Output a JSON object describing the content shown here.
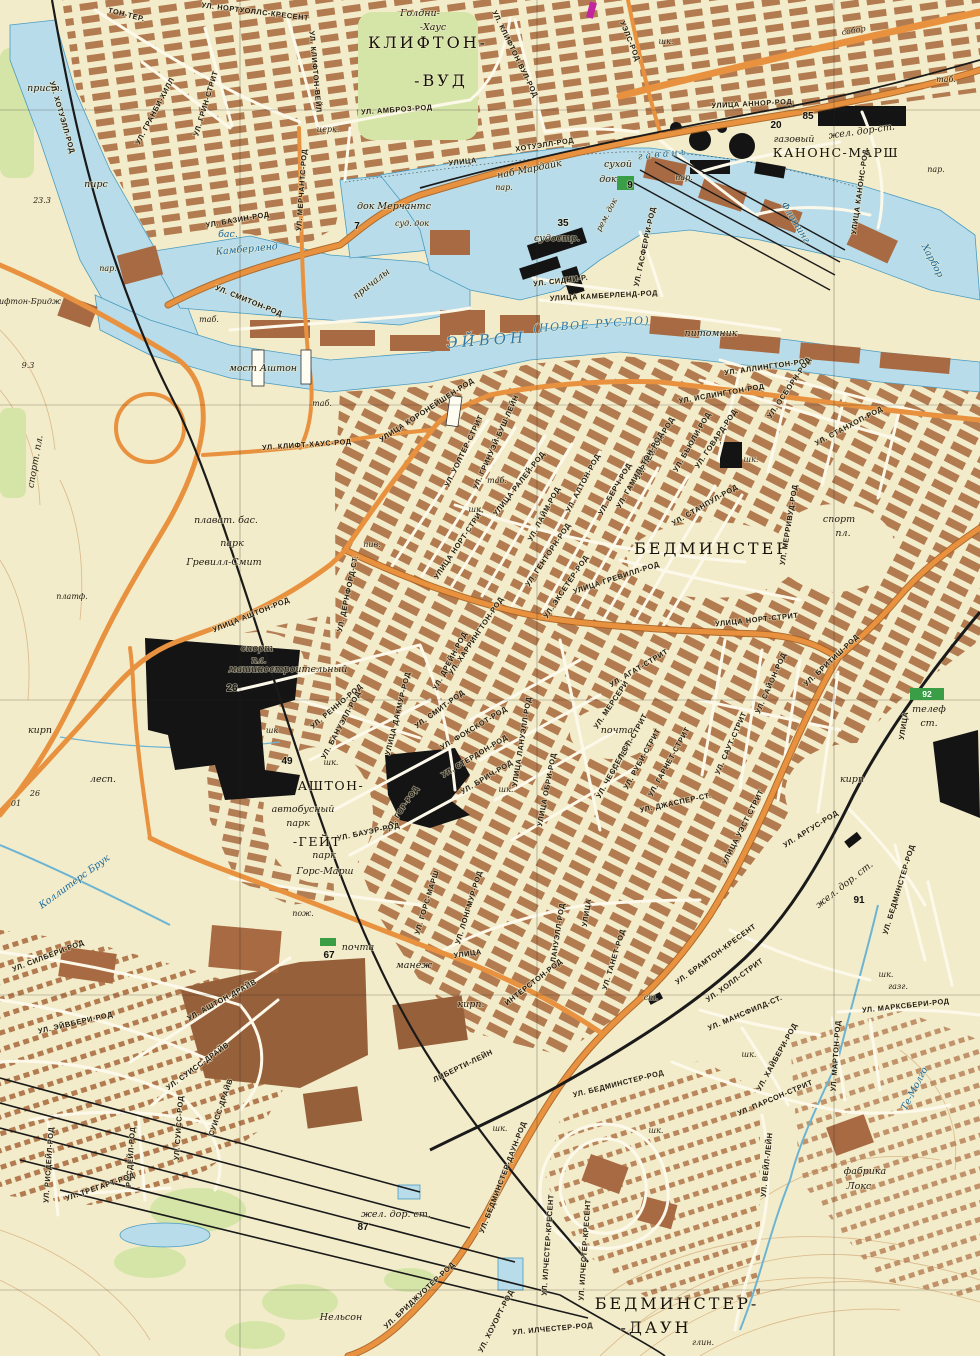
{
  "map": {
    "type": "soviet-topographic-city-map",
    "colors": {
      "paper": "#f3ecca",
      "water": "#b8dcea",
      "water_line": "#4a9cc0",
      "blocks": "#b0754a",
      "dark_blocks": "#96603a",
      "road_orange": "#e8923f",
      "road_casing": "#a9601f",
      "rail_black": "#1a1a1a",
      "park_green": "#d5e5a8",
      "badge_green": "#3a9e47",
      "label_ink": "#201a12",
      "water_ink": "#2a79ae",
      "contour": "#dcbd8f",
      "magenta_mark": "#c1269e"
    },
    "labels": [
      [
        "УЛ. НОРТУОЛЛС-КРЕСЕНТ",
        255,
        14,
        7,
        "st"
      ],
      [
        "ТОН-ТЕР.",
        126,
        17,
        14,
        "st"
      ],
      [
        "Голдни-",
        420,
        16,
        0,
        "nm"
      ],
      [
        "-Хаус",
        433,
        30,
        0,
        "nm"
      ],
      [
        "КЛИФТОН-",
        428,
        48,
        0,
        "bg"
      ],
      [
        "-ВУД",
        441,
        86,
        0,
        "bg"
      ],
      [
        "УЛ. КЛИФТОН-ВЕЙЛ",
        313,
        72,
        85,
        "st"
      ],
      [
        "УЛ. ГРАНБИ-ХИЛЛ",
        157,
        112,
        -62,
        "st"
      ],
      [
        "УЛ. ГРИН-СТРИТ",
        208,
        104,
        -73,
        "st"
      ],
      [
        "прист.",
        45,
        91,
        0,
        "nm"
      ],
      [
        "пирс",
        96,
        187,
        0,
        "nm"
      ],
      [
        "23.3",
        42,
        203,
        0,
        "sm"
      ],
      [
        "УЛ. АМБРОЗ-РОД",
        397,
        112,
        -4,
        "st"
      ],
      [
        "УЛ. КЛИФТОН-ВУЛ-РОД",
        513,
        55,
        64,
        "st"
      ],
      [
        "УЭЛС-РОД",
        628,
        42,
        68,
        "st"
      ],
      [
        "церк.",
        328,
        132,
        0,
        "sm"
      ],
      [
        "УЛИЦА",
        463,
        164,
        -6,
        "st"
      ],
      [
        "ХОТУЭЛЛ-РОД",
        545,
        147,
        -9,
        "st"
      ],
      [
        "наб Мардайк",
        530,
        172,
        -11,
        "nm"
      ],
      [
        "пар.",
        504,
        190,
        0,
        "sm"
      ],
      [
        "пар.",
        684,
        180,
        0,
        "sm"
      ],
      [
        "пар.",
        108,
        271,
        0,
        "sm"
      ],
      [
        "пар.",
        936,
        172,
        0,
        "sm"
      ],
      [
        "док Мерчантс",
        394,
        209,
        0,
        "nm"
      ],
      [
        "7",
        357,
        229,
        0,
        "nu"
      ],
      [
        "суд. док",
        412,
        226,
        0,
        "sm"
      ],
      [
        "сухой",
        618,
        167,
        0,
        "nm"
      ],
      [
        "док",
        608,
        182,
        0,
        "nm"
      ],
      [
        "9",
        630,
        188,
        0,
        "nu"
      ],
      [
        "рем. док",
        609,
        216,
        -62,
        "sm"
      ],
      [
        "35",
        563,
        226,
        0,
        "nu"
      ],
      [
        "судостр.",
        557,
        241,
        0,
        "nm"
      ],
      [
        "УЛ. СИДНИ-Р.",
        561,
        283,
        -7,
        "st"
      ],
      [
        "УЛИЦА КАМБЕРЛЕНД-РОД",
        604,
        298,
        -3,
        "st"
      ],
      [
        "УЛ. ГАСФЕРРИ-РОД",
        647,
        247,
        -78,
        "st"
      ],
      [
        "г а в а н ь",
        662,
        157,
        -6,
        "wt"
      ],
      [
        "Флотинг",
        793,
        224,
        58,
        "wt"
      ],
      [
        "Харбор",
        930,
        262,
        62,
        "wt"
      ],
      [
        "УЛИЦА АННОР-РОД",
        752,
        106,
        -3,
        "st"
      ],
      [
        "85",
        808,
        119,
        0,
        "nu"
      ],
      [
        "20",
        776,
        128,
        0,
        "nu"
      ],
      [
        "газовый",
        794,
        142,
        0,
        "nm"
      ],
      [
        "жел. дор-ст.",
        862,
        134,
        -8,
        "nm"
      ],
      [
        "КАНОНС-МАРШ",
        836,
        157,
        0,
        "md"
      ],
      [
        "собор",
        854,
        33,
        -10,
        "sm"
      ],
      [
        "шк.",
        666,
        44,
        0,
        "sm"
      ],
      [
        "УЛИЦА КАНОНС-РОД",
        862,
        192,
        -82,
        "st"
      ],
      [
        "УЛ. МЕРЧАНТС-РОД",
        304,
        190,
        -86,
        "st"
      ],
      [
        "УЛ. БАЗИН-РОД",
        238,
        222,
        -10,
        "st"
      ],
      [
        "бас.",
        228,
        237,
        0,
        "wt"
      ],
      [
        "Камберленд",
        247,
        252,
        -5,
        "wt"
      ],
      [
        "причалы",
        373,
        286,
        -38,
        "nm"
      ],
      [
        "УЛ. СМИТОН-РОД",
        248,
        303,
        22,
        "st"
      ],
      [
        "таб.",
        209,
        322,
        0,
        "sm"
      ],
      [
        "таб.",
        322,
        406,
        0,
        "sm"
      ],
      [
        "таб.",
        497,
        483,
        0,
        "sm"
      ],
      [
        "таб.",
        946,
        82,
        0,
        "sm"
      ],
      [
        "мост Аштон",
        263,
        371,
        0,
        "nm"
      ],
      [
        "ЭЙВОН",
        487,
        345,
        -4,
        "wb"
      ],
      [
        "(НОВОЕ РУСЛО)",
        592,
        328,
        -4,
        "w2"
      ],
      [
        "питомник",
        711,
        336,
        0,
        "nm"
      ],
      [
        "ифтон-Бридж",
        30,
        304,
        0,
        "sm"
      ],
      [
        "9.3",
        28,
        368,
        0,
        "sm"
      ],
      [
        "УЛ. ХОТУЭЛЛ-РОД",
        60,
        118,
        74,
        "st"
      ],
      [
        "спорт. пл.",
        38,
        462,
        -80,
        "nm"
      ],
      [
        "УЛ. КЛИФТ-ХАУС-РОД",
        307,
        447,
        -4,
        "st"
      ],
      [
        "УЛИЦА КОРОНЕЙШЕН-РОД",
        428,
        412,
        -33,
        "st"
      ],
      [
        "УЛ. УОЛТЕР-СТРИТ",
        466,
        452,
        -64,
        "st"
      ],
      [
        "УЛ. ГРИНУЭЙ-БУШ-ЛЕЙН",
        498,
        443,
        -66,
        "st"
      ],
      [
        "УЛ. АЛЛИНГТОН-РОД",
        768,
        369,
        -8,
        "st"
      ],
      [
        "УЛ. ИСЛИНГТОН-РОД",
        722,
        396,
        -10,
        "st"
      ],
      [
        "УЛ. ОСБОРН-РОД",
        791,
        389,
        -56,
        "st"
      ],
      [
        "УЛ. ГОВАРД-РОД",
        718,
        440,
        -56,
        "st"
      ],
      [
        "УЛ. БЬЮЛИ-РОД",
        694,
        443,
        -60,
        "st"
      ],
      [
        "УЛ. ЛЕЙТОН-РОД",
        657,
        449,
        -60,
        "st"
      ],
      [
        "УЛ. ГАМИЛЬТОН-РОД",
        642,
        471,
        -60,
        "st"
      ],
      [
        "УЛ. БЕРЧ-РОД",
        617,
        490,
        -60,
        "st"
      ],
      [
        "УЛ. СТАНХОП-РОД",
        850,
        428,
        -28,
        "st"
      ],
      [
        "УЛ. СТАНПУЛ-РОД",
        706,
        507,
        -30,
        "st"
      ],
      [
        "УЛИЦА РАЛЕЙ-РОД",
        521,
        485,
        -52,
        "st"
      ],
      [
        "УЛ. АЛТОН-РОД",
        585,
        484,
        -62,
        "st"
      ],
      [
        "УЛ. ЛАЙМ-РОД",
        546,
        515,
        -62,
        "st"
      ],
      [
        "УЛ. ГЕНТОРН-РОД",
        550,
        556,
        -56,
        "st"
      ],
      [
        "УЛ. ЭКСЕТЕР-РОД",
        568,
        588,
        -56,
        "st"
      ],
      [
        "УЛИЦА ГРЕВИЛЛ-РОД",
        617,
        580,
        -18,
        "st"
      ],
      [
        "УЛИЦА НОРТ-СТРИТ",
        461,
        545,
        -56,
        "st"
      ],
      [
        "УЛИЦА НОРТ-СТРИТ",
        757,
        622,
        -6,
        "st"
      ],
      [
        "БЕДМИНСТЕР",
        712,
        554,
        0,
        "bg"
      ],
      [
        "УЛ. МЕРРИВУД-РОД",
        791,
        525,
        -81,
        "st"
      ],
      [
        "спорт",
        839,
        522,
        0,
        "nm"
      ],
      [
        "пл.",
        843,
        536,
        0,
        "nm"
      ],
      [
        "шк.",
        476,
        512,
        0,
        "sm"
      ],
      [
        "шк.",
        751,
        462,
        0,
        "sm"
      ],
      [
        "плават. бас.",
        226,
        523,
        0,
        "nm"
      ],
      [
        "парк",
        232,
        546,
        0,
        "nm"
      ],
      [
        "Гревилл-Смит",
        224,
        565,
        0,
        "nm"
      ],
      [
        "платф.",
        72,
        599,
        0,
        "sm"
      ],
      [
        "УЛИЦА АШТОН-РОД",
        252,
        617,
        -22,
        "st"
      ],
      [
        "УЛ. ДЕРНФОРД-СТ.",
        350,
        594,
        -78,
        "st"
      ],
      [
        "пив.",
        372,
        547,
        0,
        "sm"
      ],
      [
        "спорт",
        257,
        651,
        0,
        "nm"
      ],
      [
        "пл.",
        259,
        663,
        0,
        "nm"
      ],
      [
        "машиностроительный",
        288,
        672,
        0,
        "nm"
      ],
      [
        "26",
        232,
        691,
        0,
        "nu"
      ],
      [
        "кирп",
        40,
        733,
        0,
        "nm"
      ],
      [
        "лесп.",
        103,
        782,
        0,
        "nm"
      ],
      [
        "26",
        35,
        796,
        0,
        "sm"
      ],
      [
        "01",
        16,
        806,
        0,
        "sm"
      ],
      [
        "УЛ. РЕННО-РОД",
        338,
        708,
        -40,
        "st"
      ],
      [
        "УЛ. БАНУЭЛЛ-РОД",
        343,
        726,
        -62,
        "st"
      ],
      [
        "УЛИЦА ДАКМУР-РОД",
        400,
        714,
        -76,
        "st"
      ],
      [
        "УЛ. СМИТ-РОД",
        441,
        711,
        -36,
        "st"
      ],
      [
        "УЛ. ГОР-РОД",
        404,
        810,
        -56,
        "st"
      ],
      [
        "УЛ. БАУЭР-РОД",
        369,
        834,
        -12,
        "st"
      ],
      [
        "шк",
        272,
        733,
        0,
        "sm"
      ],
      [
        "шк.",
        331,
        765,
        0,
        "sm"
      ],
      [
        "49",
        287,
        764,
        0,
        "nu"
      ],
      [
        "АШТОН-",
        331,
        790,
        0,
        "md"
      ],
      [
        "-ГЕЙТ",
        317,
        846,
        0,
        "md"
      ],
      [
        "автобусный",
        303,
        812,
        0,
        "nm"
      ],
      [
        "парк",
        298,
        826,
        0,
        "nm"
      ],
      [
        "парк",
        324,
        858,
        0,
        "nm"
      ],
      [
        "Горс-Марш",
        325,
        874,
        0,
        "nm"
      ],
      [
        "УЛ. ХАРРИНГТОН-РОД",
        478,
        637,
        -56,
        "st"
      ],
      [
        "УЛ. ДРЕЙН-РОД",
        452,
        662,
        -62,
        "st"
      ],
      [
        "УЛ. ФОКСКОТ-РОД",
        475,
        730,
        -31,
        "st"
      ],
      [
        "УЛ. СТЕРДОН-РОД",
        476,
        758,
        -31,
        "st"
      ],
      [
        "УЛ. БРИЧ-РОД",
        488,
        779,
        -31,
        "st"
      ],
      [
        "УЛИЦА ЛАНУЭЛЛ-РОД",
        524,
        742,
        -81,
        "st"
      ],
      [
        "УЛИЦА ОБРИ-РОД",
        549,
        790,
        -79,
        "st"
      ],
      [
        "почта",
        617,
        733,
        0,
        "nm"
      ],
      [
        "УЛ. АГАТ-СТРИТ",
        640,
        670,
        -31,
        "st"
      ],
      [
        "УЛ. МЕРСЕРИ",
        613,
        706,
        -56,
        "st"
      ],
      [
        "УЛ. ПЕРЛ-СТРИТ",
        631,
        745,
        -61,
        "st"
      ],
      [
        "УЛ. ЧЕССЕЛ-СТ.",
        616,
        770,
        -61,
        "st"
      ],
      [
        "УЛ. РУБИ-СТРИТ",
        644,
        760,
        -61,
        "st"
      ],
      [
        "УЛ. ГАРНЕТ-СТРИТ",
        671,
        763,
        -61,
        "st"
      ],
      [
        "УЛ. ДЖАСПЕР-СТ.",
        676,
        805,
        -12,
        "st"
      ],
      [
        "шк.",
        506,
        792,
        0,
        "sm"
      ],
      [
        "УЛ. САЙОН-РОД",
        773,
        684,
        -66,
        "st"
      ],
      [
        "УЛ. БРИТИШ-РОД",
        833,
        662,
        -43,
        "st"
      ],
      [
        "УЛ. САУТ-СТРИТ",
        733,
        744,
        -66,
        "st"
      ],
      [
        "УЛИЦА УЭСТ-СТРИТ",
        745,
        828,
        -63,
        "st"
      ],
      [
        "УЛ. АРГУС-РОД",
        812,
        831,
        -32,
        "st"
      ],
      [
        "кирп",
        852,
        782,
        0,
        "nm"
      ],
      [
        "телеф",
        929,
        712,
        0,
        "nm"
      ],
      [
        "ст.",
        929,
        726,
        0,
        "nm"
      ],
      [
        "92",
        927,
        697,
        0,
        "nw"
      ],
      [
        "УЛИЦА",
        906,
        726,
        -81,
        "st"
      ],
      [
        "Коллитерс Брук",
        76,
        884,
        -36,
        "wt"
      ],
      [
        "пож.",
        303,
        916,
        0,
        "sm"
      ],
      [
        "почта",
        358,
        950,
        0,
        "nm"
      ],
      [
        "67",
        329,
        958,
        0,
        "nu"
      ],
      [
        "манеж",
        414,
        968,
        0,
        "nm"
      ],
      [
        "кирп.",
        471,
        1007,
        0,
        "nm"
      ],
      [
        "УЛ. ГОРС-МАРШ",
        429,
        903,
        -73,
        "st"
      ],
      [
        "УЛ. ЛОНГМУР-РОД",
        471,
        908,
        -73,
        "st"
      ],
      [
        "УЛИЦА",
        468,
        956,
        -8,
        "st"
      ],
      [
        "ИНТЕРСТОН-РОД",
        535,
        984,
        -38,
        "st"
      ],
      [
        "УЛИЦА",
        589,
        913,
        -81,
        "st"
      ],
      [
        "ЛАНУЭЛЛ-РОД",
        560,
        933,
        -81,
        "st"
      ],
      [
        "ЛИБЕРТИ-ЛЕЙН",
        464,
        1068,
        -26,
        "st"
      ],
      [
        "жел. дор. ст.",
        846,
        887,
        -38,
        "nm"
      ],
      [
        "91",
        859,
        903,
        0,
        "nu"
      ],
      [
        "УЛ. БЕДМИНСТЕР-РОД",
        901,
        890,
        -73,
        "st"
      ],
      [
        "шк.",
        886,
        977,
        0,
        "sm"
      ],
      [
        "газг.",
        898,
        989,
        0,
        "sm"
      ],
      [
        "УЛ. МАРКСБЕРИ-РОД",
        906,
        1008,
        -6,
        "st"
      ],
      [
        "УЛ. МАРТОН-РОД",
        838,
        1056,
        -86,
        "st"
      ],
      [
        "УЛ. ХАЙБЕРИ-РОД",
        779,
        1058,
        -61,
        "st"
      ],
      [
        "УЛ. БРАМТОН-КРЕСЕНТ",
        717,
        956,
        -36,
        "st"
      ],
      [
        "УЛ. ХОЛЛ-СТРИТ",
        736,
        982,
        -36,
        "st"
      ],
      [
        "УЛ. МАНСФИЛД-СТ.",
        746,
        1015,
        -23,
        "st"
      ],
      [
        "ст.",
        651,
        1000,
        0,
        "sm"
      ],
      [
        "УЛ. ТАНЕТ-РОД",
        616,
        960,
        -73,
        "st"
      ],
      [
        "шк.",
        749,
        1057,
        0,
        "sm"
      ],
      [
        "УЛ. БЕДМИНСТЕР-РОД",
        619,
        1086,
        -14,
        "st"
      ],
      [
        "УЛ. ПАРСОН-СТРИТ",
        776,
        1100,
        -23,
        "st"
      ],
      [
        "УЛ. ВЕЙЛ-ЛЕЙН",
        769,
        1165,
        -84,
        "st"
      ],
      [
        "фабрика",
        865,
        1174,
        0,
        "nm"
      ],
      [
        "Локс",
        859,
        1189,
        0,
        "nm"
      ],
      [
        "Те-Молго",
        917,
        1090,
        -63,
        "wt"
      ],
      [
        "УЛ. СИЛБЕРИ-РОД",
        49,
        958,
        -21,
        "st"
      ],
      [
        "УЛ. ЭЙВБЕРИ-РОД",
        76,
        1025,
        -13,
        "st"
      ],
      [
        "УЛ. АШТОН-ДРАЙВ",
        223,
        1002,
        -29,
        "st"
      ],
      [
        "УЛ. СУИСС-ДРАЙВ",
        199,
        1068,
        -36,
        "st"
      ],
      [
        "СУИСС-ДРАЙВ",
        223,
        1108,
        -71,
        "st"
      ],
      [
        "УЛ. СУИСС-РОД",
        181,
        1128,
        -86,
        "st"
      ],
      [
        "УЛ. РИСДЕЙЛ-РОД",
        51,
        1165,
        -86,
        "st"
      ],
      [
        "РИСДЕЙЛ-РОД",
        133,
        1157,
        -86,
        "st"
      ],
      [
        "УЛ. ТРЕГАРТ-РОД",
        101,
        1189,
        -19,
        "st"
      ],
      [
        "жел. дор. ст.",
        396,
        1217,
        0,
        "nm"
      ],
      [
        "87",
        363,
        1230,
        0,
        "nu"
      ],
      [
        "Нельсон",
        341,
        1320,
        0,
        "nm"
      ],
      [
        "УЛ. БЕДМИНСТЕР-ДАУН-РОД",
        505,
        1178,
        -69,
        "st"
      ],
      [
        "УЛ. БРИДЖУОТЕР-РОД",
        421,
        1297,
        -43,
        "st"
      ],
      [
        "УЛ. ХОУОРТ-РОД",
        498,
        1322,
        -63,
        "st"
      ],
      [
        "УЛ. ИЛЧЕСТЕР-КРЕСЕНТ",
        550,
        1245,
        -86,
        "st"
      ],
      [
        "УЛ. ИЛЧЕСТЕР-КРЕСЕНТ",
        587,
        1250,
        -86,
        "st"
      ],
      [
        "УЛ. ИЛЧЕСТЕР-РОД",
        553,
        1331,
        -5,
        "st"
      ],
      [
        "БЕДМИНСТЕР-",
        677,
        1309,
        0,
        "bg"
      ],
      [
        "-ДАУН",
        656,
        1333,
        0,
        "bg"
      ],
      [
        "глин.",
        703,
        1345,
        0,
        "sm"
      ],
      [
        "шк.",
        656,
        1133,
        0,
        "sm"
      ],
      [
        "шк.",
        500,
        1131,
        0,
        "sm"
      ]
    ]
  }
}
